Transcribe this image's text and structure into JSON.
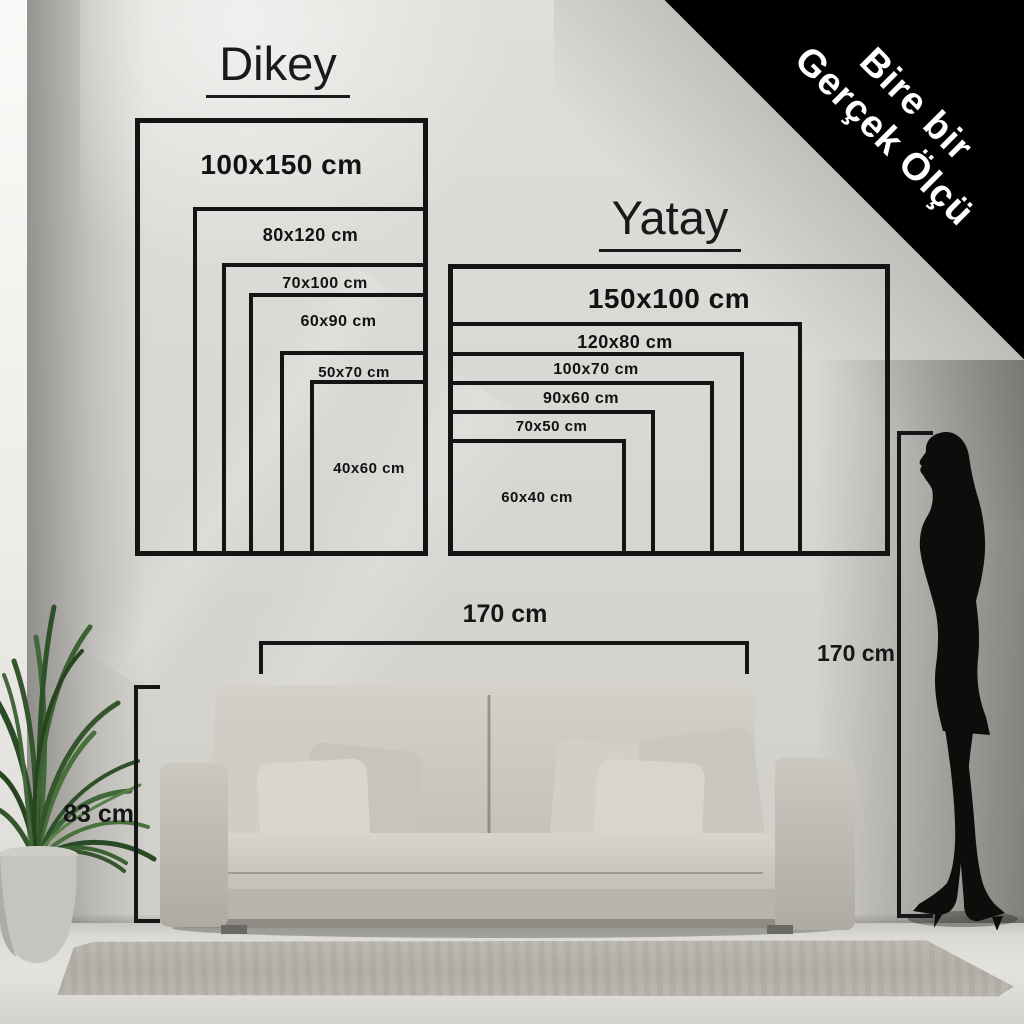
{
  "ribbon": {
    "line1": "Bire bir",
    "line2": "Gerçek Ölçü",
    "background": "#000000",
    "text_color": "#ffffff"
  },
  "orientation_groups": {
    "dikey": {
      "title": "Dikey",
      "sizes": [
        "100x150 cm",
        "80x120 cm",
        "70x100 cm",
        "60x90 cm",
        "50x70 cm",
        "40x60 cm"
      ]
    },
    "yatay": {
      "title": "Yatay",
      "sizes": [
        "150x100 cm",
        "120x80 cm",
        "100x70 cm",
        "90x60 cm",
        "70x50 cm",
        "60x40 cm"
      ]
    }
  },
  "measurements": {
    "sofa_width": "170 cm",
    "sofa_height": "83 cm",
    "person_height": "170 cm"
  },
  "scene": {
    "colors": {
      "wall": "#d8d7d3",
      "outline": "#141414",
      "sofa": "#cdcac1",
      "rug": "#b3b0a7",
      "floor": "#dcdbd7",
      "plant_leaf": "#3c5e33",
      "silhouette": "#0d0d0c"
    }
  }
}
